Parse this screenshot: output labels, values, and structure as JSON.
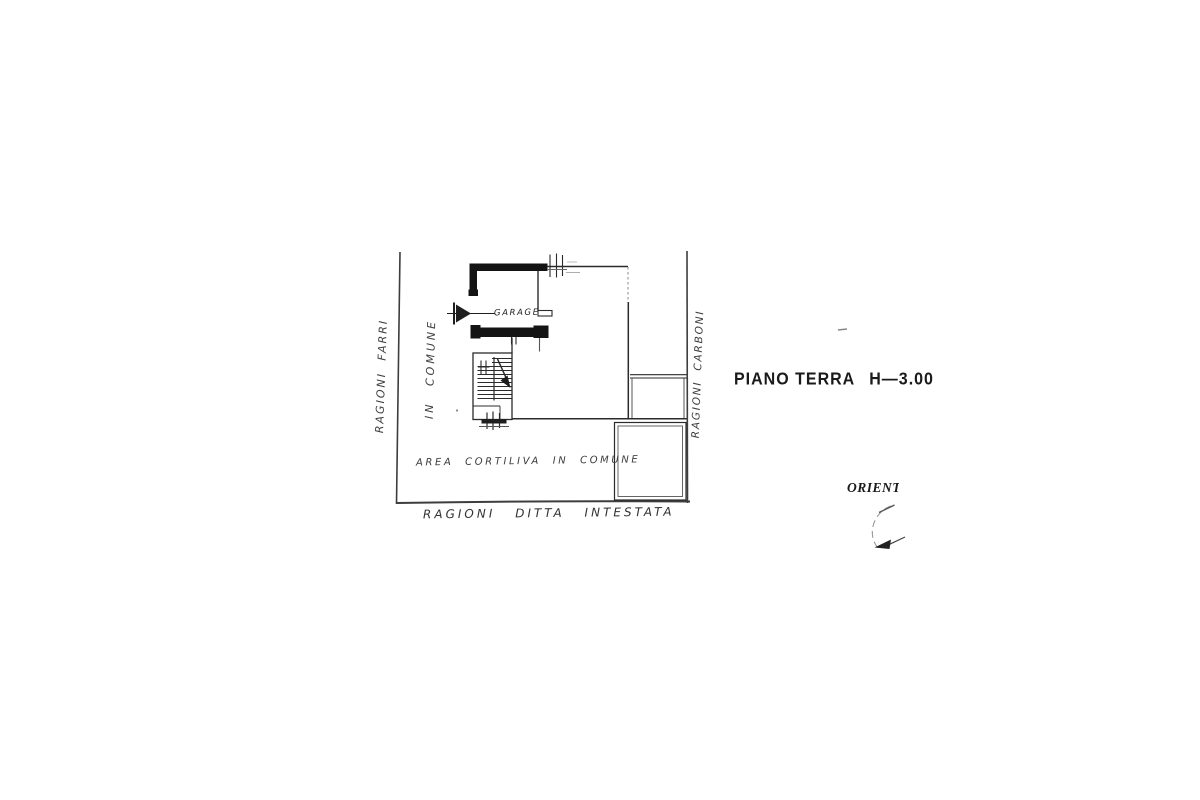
{
  "plan": {
    "title": "PIANO TERRA",
    "title_height": "H—3.00",
    "labels": {
      "neighbor_left": "RAGIONI FARRI",
      "common_strip": "IN COMUNE",
      "neighbor_right": "RAGIONI CARBONI",
      "owner_bottom": "RAGIONI DITTA INTESTATA",
      "courtyard": "AREA CORTILIVA IN COMUNE",
      "garage": "GARAGE",
      "orientation": "ORIENT"
    },
    "colors": {
      "ink": "#2b2b2b",
      "wall_fill": "#141414",
      "faint_line": "#8a8a8a",
      "paper": "#ffffff"
    }
  }
}
